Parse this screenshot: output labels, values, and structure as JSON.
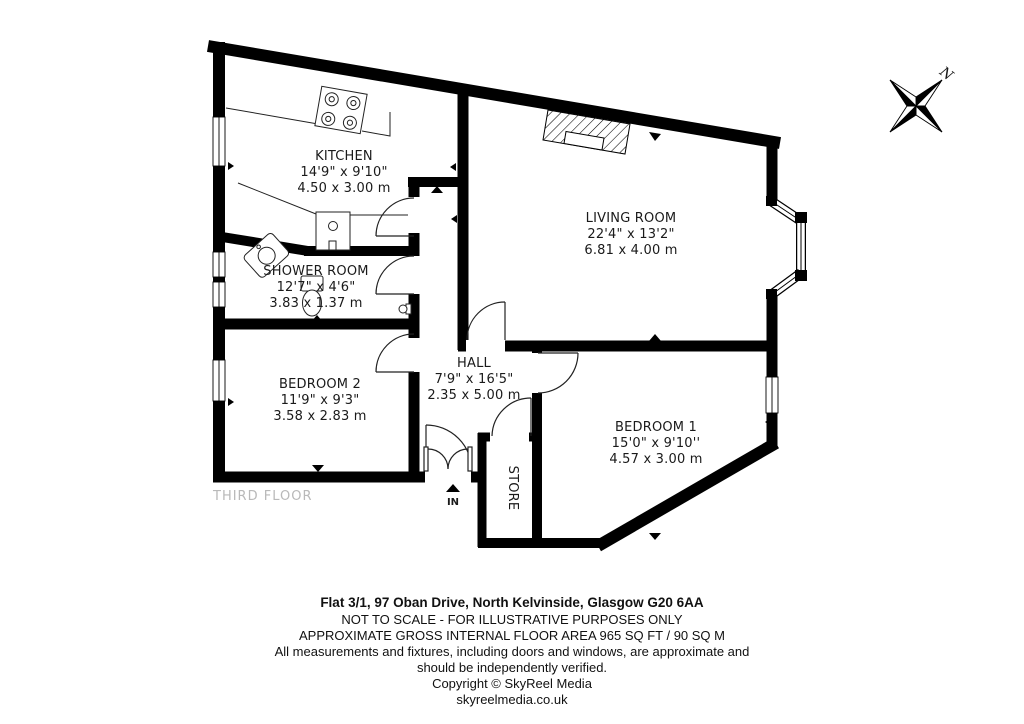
{
  "floorplan": {
    "floor_label": "THIRD FLOOR",
    "entrance_label": "IN",
    "compass_label": "N",
    "rooms": {
      "kitchen": {
        "name": "KITCHEN",
        "imperial": "14'9\" x 9'10\"",
        "metric": "4.50 x 3.00 m"
      },
      "living_room": {
        "name": "LIVING ROOM",
        "imperial": "22'4\" x 13'2\"",
        "metric": "6.81 x 4.00 m"
      },
      "shower_room": {
        "name": "SHOWER ROOM",
        "imperial": "12'7\" x 4'6\"",
        "metric": "3.83 x 1.37 m"
      },
      "bedroom_2": {
        "name": "BEDROOM 2",
        "imperial": "11'9\" x 9'3\"",
        "metric": "3.58 x 2.83 m"
      },
      "hall": {
        "name": "HALL",
        "imperial": "7'9\" x 16'5\"",
        "metric": "2.35 x 5.00 m"
      },
      "bedroom_1": {
        "name": "BEDROOM 1",
        "imperial": "15'0\" x 9'10''",
        "metric": "4.57 x 3.00 m"
      },
      "store": {
        "name": "STORE"
      }
    }
  },
  "footer": {
    "address": "Flat 3/1, 97 Oban Drive, North Kelvinside, Glasgow G20 6AA",
    "disclaimer_scale": "NOT TO SCALE - FOR ILLUSTRATIVE PURPOSES ONLY",
    "area": "APPROXIMATE GROSS INTERNAL FLOOR AREA 965 SQ FT / 90 SQ M",
    "disclaimer_measurements_1": "All measurements and fixtures, including doors and windows, are approximate and",
    "disclaimer_measurements_2": "should be independently verified.",
    "copyright": "Copyright © SkyReel Media",
    "website": "skyreelmedia.co.uk"
  },
  "colors": {
    "wall": "#000000",
    "floor_label_gray": "#b9b9b9",
    "background": "#ffffff"
  }
}
